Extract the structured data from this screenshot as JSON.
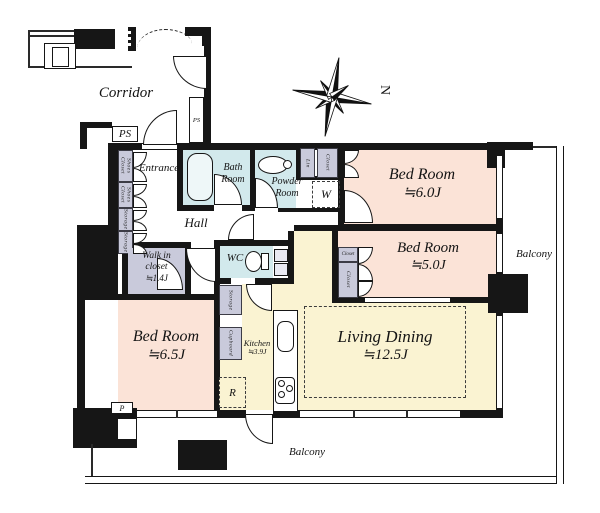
{
  "labels": {
    "corridor": "Corridor",
    "ps": "PS",
    "entrance": "Entrance",
    "hall": "Hall",
    "bath_line1": "Bath",
    "bath_line2": "Room",
    "powder_line1": "Powder",
    "powder_line2": "Room",
    "wc": "WC",
    "lin": "Lin",
    "closet": "Closet",
    "shoes_closet": "Shoes Closet",
    "storage": "Storage",
    "cupboard": "Cupboard",
    "washer": "W",
    "fridge": "R",
    "parking": "P",
    "north": "N",
    "balcony": "Balcony"
  },
  "rooms": {
    "bedroom_ne": {
      "name": "Bed Room",
      "size": "≒6.0J"
    },
    "bedroom_e": {
      "name": "Bed Room",
      "size": "≒5.0J"
    },
    "bedroom_sw": {
      "name": "Bed Room",
      "size": "≒6.5J"
    },
    "living_dining": {
      "name": "Living Dining",
      "size": "≒12.5J"
    },
    "kitchen": {
      "name": "Kitchen",
      "size": "≒3.9J"
    },
    "walk_in_closet": {
      "name_line1": "Walk in",
      "name_line2": "closet",
      "size": "≒1.4J"
    }
  },
  "colors": {
    "bedroom_fill": "#fbe3d7",
    "living_fill": "#faf3d2",
    "wet_area_fill": "#d2e9ec",
    "closet_fill": "#c9cadb",
    "wall": "#161616"
  }
}
